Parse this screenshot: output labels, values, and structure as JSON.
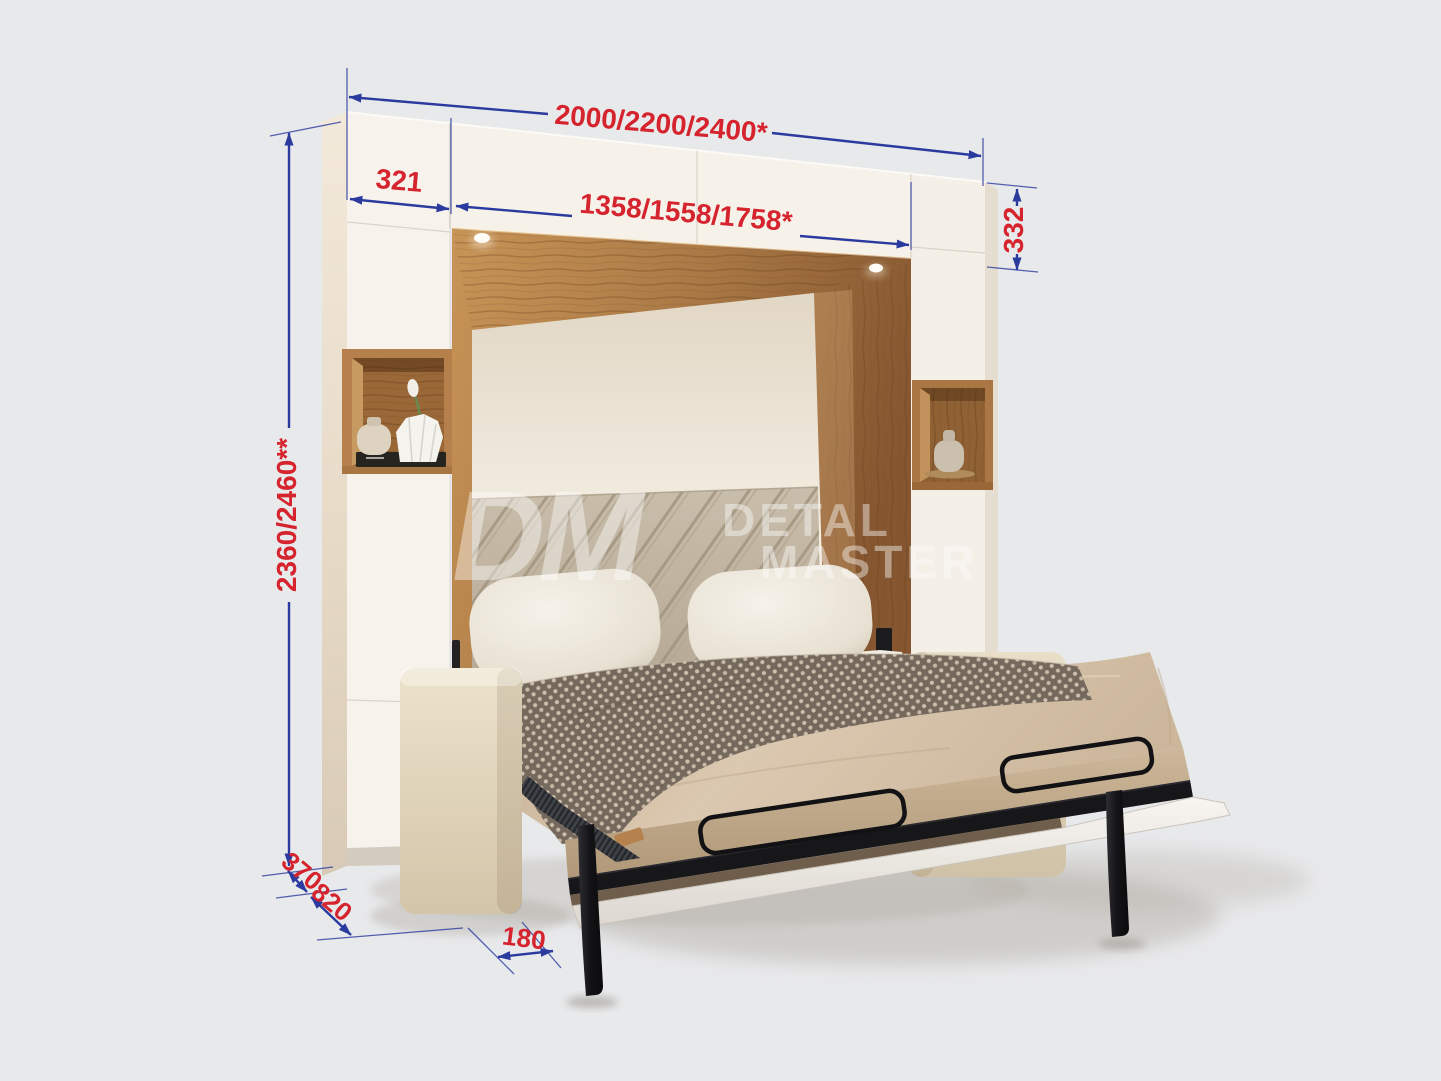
{
  "watermark": {
    "monogram": "DM",
    "line1": "DETAL",
    "line2": "MASTER"
  },
  "dims": {
    "total_width": "2000/2200/2400*",
    "left_column_width": "321",
    "inner_width": "1358/1558/1758*",
    "top_cabinet_height": "332",
    "total_height": "2360/2460**",
    "cabinet_depth": "370",
    "sofa_depth": "820",
    "leg_inset": "180"
  },
  "colors": {
    "background": "#e8e9eb",
    "dimension_line_blue": "#2a3a9f",
    "dimension_text_red": "#d5242e",
    "cabinet_white": "#f7f3ec",
    "wood": "#a97844",
    "headboard": "#c3b7a4",
    "bedding": "#d5c1a8",
    "blanket": "#75695d",
    "metal_black": "#17171a"
  }
}
